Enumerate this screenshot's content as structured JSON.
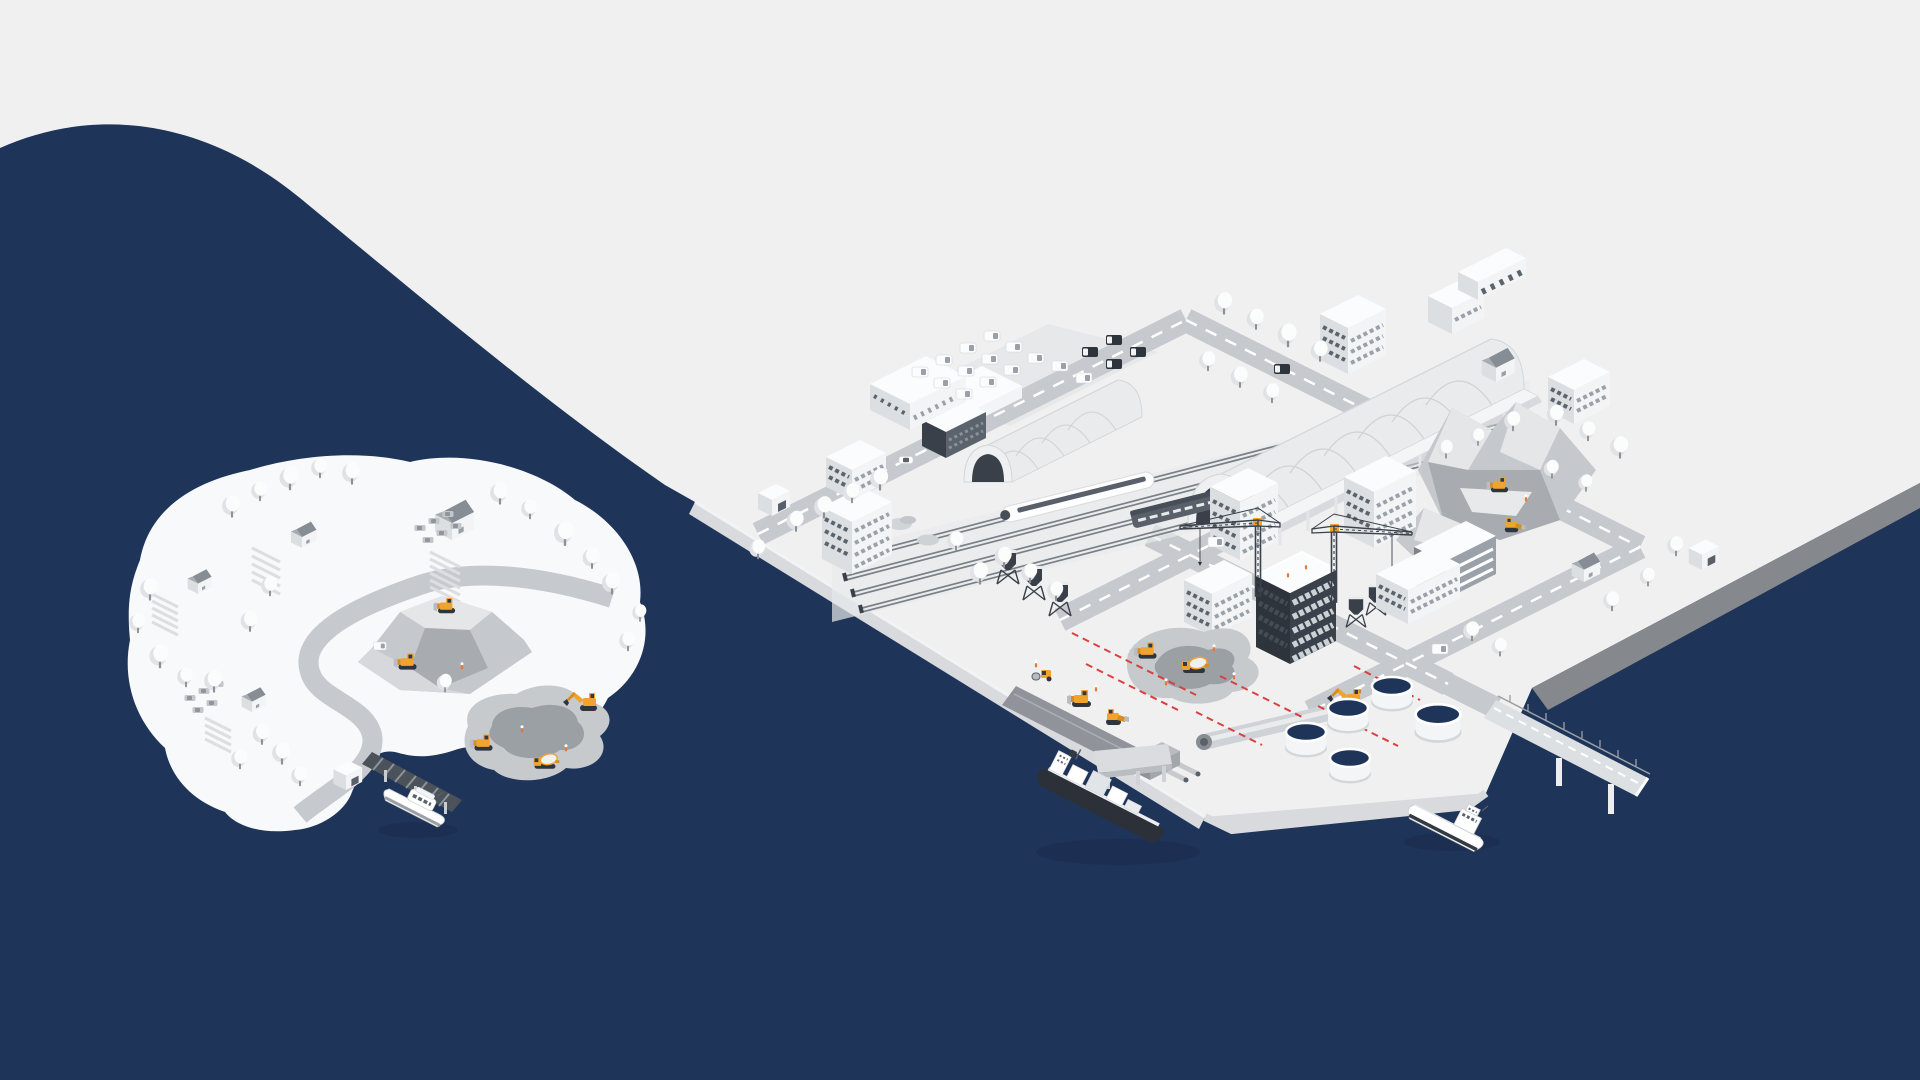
{
  "scene": {
    "type": "isometric-illustration",
    "description": "Isometric illustration of a coastal construction city with a railway station, port, tower cranes, storage tanks, ships and a quarry island with yellow machines, on a navy sea with a light background",
    "width": 1920,
    "height": 1080
  },
  "colors": {
    "bg": "#f0f0f1",
    "water": "#1f3459",
    "island": "#f8f9fa",
    "road": "#c6c9cd",
    "roadline": "#ffffff",
    "walltop": "#fbfcfd",
    "walllight": "#f3f4f6",
    "wallshade": "#dcdfe2",
    "walldark": "#c9ccd1",
    "win": "#9aa1a8",
    "windark": "#5b636d",
    "frame": "#3a414b",
    "glass": "#ccd1d6",
    "dark": "#2f353c",
    "yellow": "#f0a32f",
    "yellowdark": "#d88d20",
    "red": "#d94040",
    "tree": "#fbfcfc",
    "treeshade": "#e0e2e5",
    "trunk": "#8d9196",
    "rock1": "#e4e6e8",
    "rock2": "#c5c8cc",
    "rock3": "#a8acb1",
    "pit1": "#c7cacd",
    "pit2": "#9ba0a5",
    "embank": "#d8dadd",
    "embankdark": "#85888c",
    "strip": "#90949a",
    "hull": "#2c3139",
    "steel": "#b9bdc2",
    "orange": "#e07a3a",
    "shadow": "#1a2c4e"
  },
  "elements": {
    "illustration": "Isometric construction and logistics cityscape",
    "water": "Navy sea",
    "island": "Quarry island with winding road, farms and construction machines",
    "quarry": "Rock quarry hill with bulldozers",
    "island_pit": "Excavation pit with excavator and mixer",
    "city": "Port city on a platform",
    "station": "Railway station with arched halls and trains",
    "parking": "Parking lot with vans and trucks",
    "construction_site": "High-rise under construction with two tower cranes",
    "dig_site": "Road construction pit with machines and red survey lines",
    "pipeline": "Pipeline being laid by excavator",
    "tanks": "Storage tanks with navy lids",
    "mountains": "Rocky hills with wheel loaders",
    "bridge": "Pier bridge over the sea",
    "cargo_ship": "Container cargo ship",
    "boat": "Small motor boat",
    "ferry": "Boat moored at the island pier",
    "waterfront": "Quay strip under construction"
  }
}
